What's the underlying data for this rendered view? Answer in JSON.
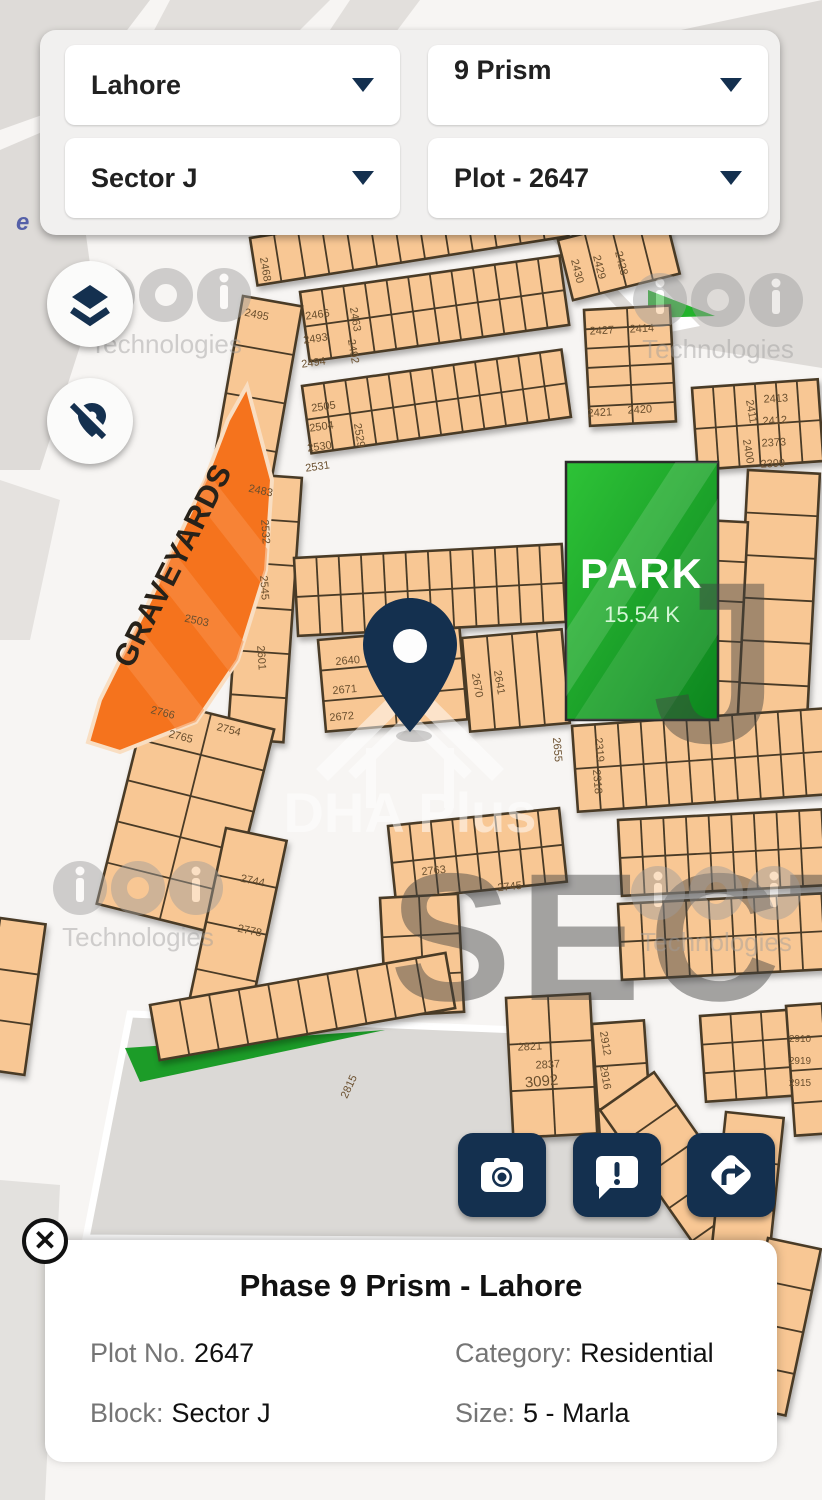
{
  "selectors": {
    "city": "Lahore",
    "phase": "9 Prism",
    "sector": "Sector J",
    "plot": "Plot - 2647"
  },
  "map": {
    "park": {
      "name": "PARK",
      "size": "15.54 K"
    },
    "graveyards": {
      "label": "GRAVEYARDS"
    },
    "watermark": {
      "brand": "DHA Plus",
      "tech": "Technologies",
      "sector_text": "SECTOR",
      "sector_letter": "J",
      "road_label": "e"
    },
    "plot_numbers": [
      "2468",
      "2495",
      "2503",
      "2466",
      "2493",
      "2494",
      "2463",
      "2492",
      "2505",
      "2504",
      "2530",
      "2531",
      "2529",
      "2430",
      "2429",
      "2428",
      "2427",
      "2414",
      "2421",
      "2420",
      "2411",
      "2400",
      "2413",
      "2412",
      "2373",
      "2399",
      "2532",
      "2601",
      "2640",
      "2671",
      "2672",
      "2670",
      "2641",
      "2766",
      "2765",
      "2754",
      "2744",
      "2778",
      "2763",
      "2745",
      "2655",
      "2319",
      "2318",
      "2821",
      "2837",
      "3092",
      "2815",
      "2912",
      "2916",
      "2910",
      "2919",
      "2483",
      "2545",
      "2915"
    ]
  },
  "actions": {
    "camera": "camera",
    "report": "report-issue",
    "directions": "directions"
  },
  "info_card": {
    "title": "Phase 9 Prism - Lahore",
    "close": "✕",
    "fields": [
      {
        "label": "Plot No.",
        "value": "2647"
      },
      {
        "label": "Category:",
        "value": "Residential"
      },
      {
        "label": "Block:",
        "value": "Sector J"
      },
      {
        "label": "Size:",
        "value": "5 - Marla"
      }
    ]
  },
  "colors": {
    "navy": "#14304f",
    "plot_fill": "#f8c794",
    "plot_border": "#4a3a27",
    "park_green_top": "#2ec337",
    "park_green_bottom": "#0c851e",
    "graveyard_orange": "#f5731d"
  }
}
